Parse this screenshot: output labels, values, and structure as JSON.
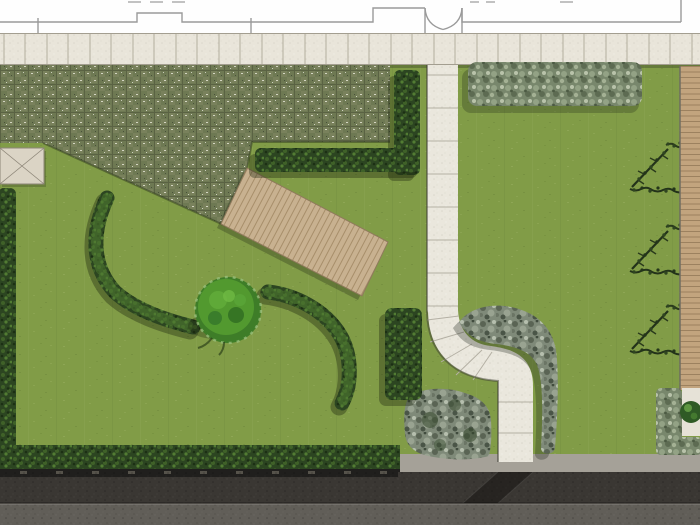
{
  "scene": {
    "kind": "landscape-garden-plan-rendering",
    "areas": {
      "house_interior": {
        "label": "house interior strip with wall outline and double-door swing"
      },
      "terrace_band": {
        "label": "limestone paver terrace band along the house"
      },
      "grass_paver_area": {
        "label": "checkered grass-paver surface with diagonal tongue"
      },
      "left_lawn": {
        "label": "west lawn"
      },
      "right_lawn": {
        "label": "east lawn"
      },
      "timber_deck_path": {
        "label": "slanted timber plank deck"
      },
      "stone_walkway": {
        "label": "stone walkway with S-curve jog"
      },
      "rock_border": {
        "label": "gravel-rock border hook beside walkway"
      },
      "rock_bed": {
        "label": "gravel-rock bed left of lower walkway"
      },
      "topiary_bush": {
        "label": "round clipped bush"
      },
      "hedge_arcs": {
        "label": "two curved shrub arcs around bush"
      },
      "espaliers": {
        "label": "three espalier tree symbols with berries"
      },
      "deck_strip": {
        "label": "timber deck strip along east boundary"
      },
      "corner_patio": {
        "label": "paved corner pad with plant"
      },
      "street": {
        "label": "bottom street: hedge, fence, asphalt, sidewalk, crossing"
      }
    }
  },
  "palette": {
    "wall_bg": "#fefefe",
    "wall_line": "#9a9a9a",
    "tick_line": "#c2c2c2",
    "paver_band": "#e9e5da",
    "paver_joint": "#b3ae9f",
    "lawn": "#819c47",
    "grass_paver": "#6e7953",
    "hedge_dark": "#2c4521",
    "hedge_gray": "#78876c",
    "bush_green": "#3e7d28",
    "deck_wood": "#c8b190",
    "deck_strip_wood": "#c2a47e",
    "stone_path": "#eae7dd",
    "stone_joint": "#b4b0a4",
    "rock_gray": "#7f8a79",
    "concrete": "#a5a198",
    "fence": "#201f1d",
    "asphalt": "#3a3733",
    "sidewalk": "#615e58",
    "espalier_branch": "#26351b",
    "berry_orange": "#b36a28",
    "table_symbol": "#dbd4c5",
    "corner_pad": "#e6e2d7"
  }
}
